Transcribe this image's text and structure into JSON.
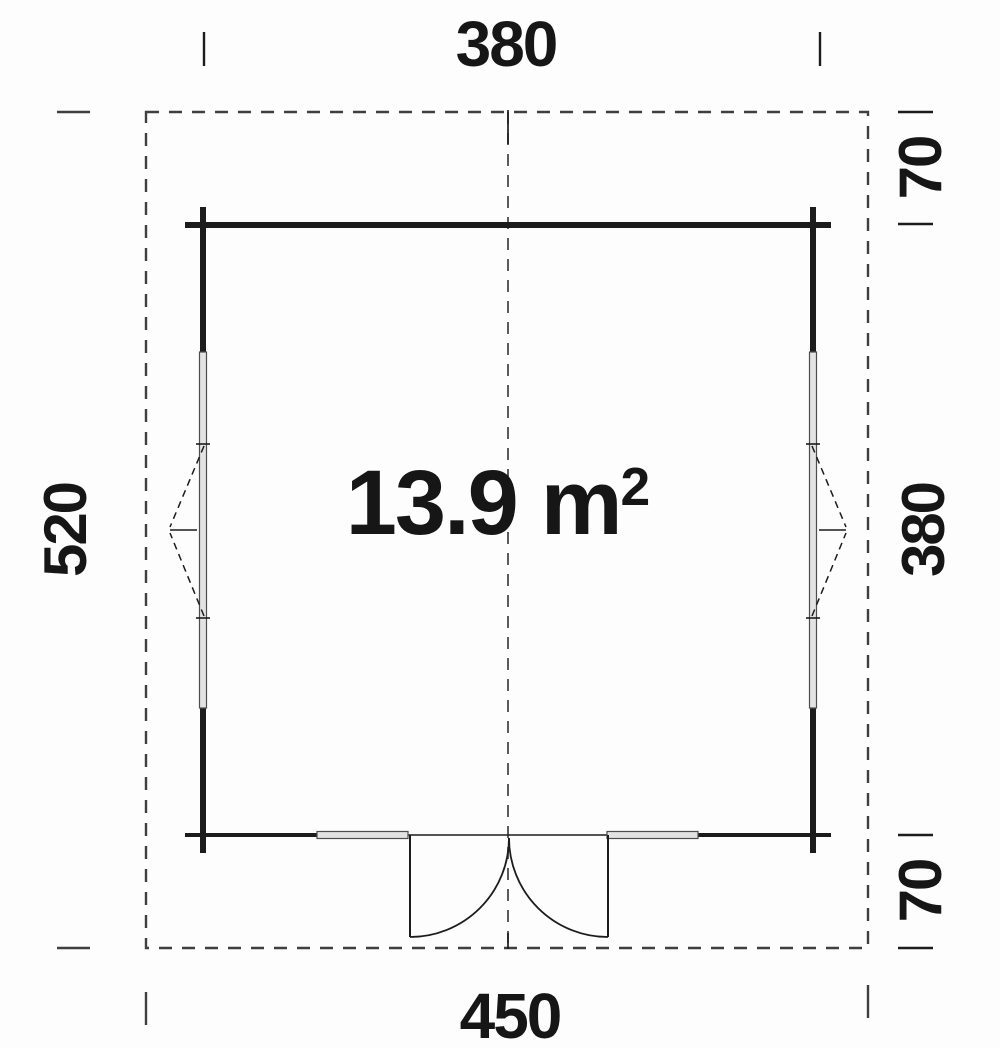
{
  "floor_plan": {
    "area": {
      "value": "13.9",
      "unit": "m",
      "exponent": "2"
    },
    "dimensions": {
      "top_width": "380",
      "bottom_width": "450",
      "left_height": "520",
      "right_height": "380",
      "top_overhang": "70",
      "bottom_overhang": "70"
    },
    "colors": {
      "line": "#1c1c1c",
      "dashed": "#3f3f3f",
      "window_fill": "#e3e3e3",
      "window_edge": "#4d4d4d",
      "text": "#161616",
      "background": "#fdfdfd"
    }
  }
}
